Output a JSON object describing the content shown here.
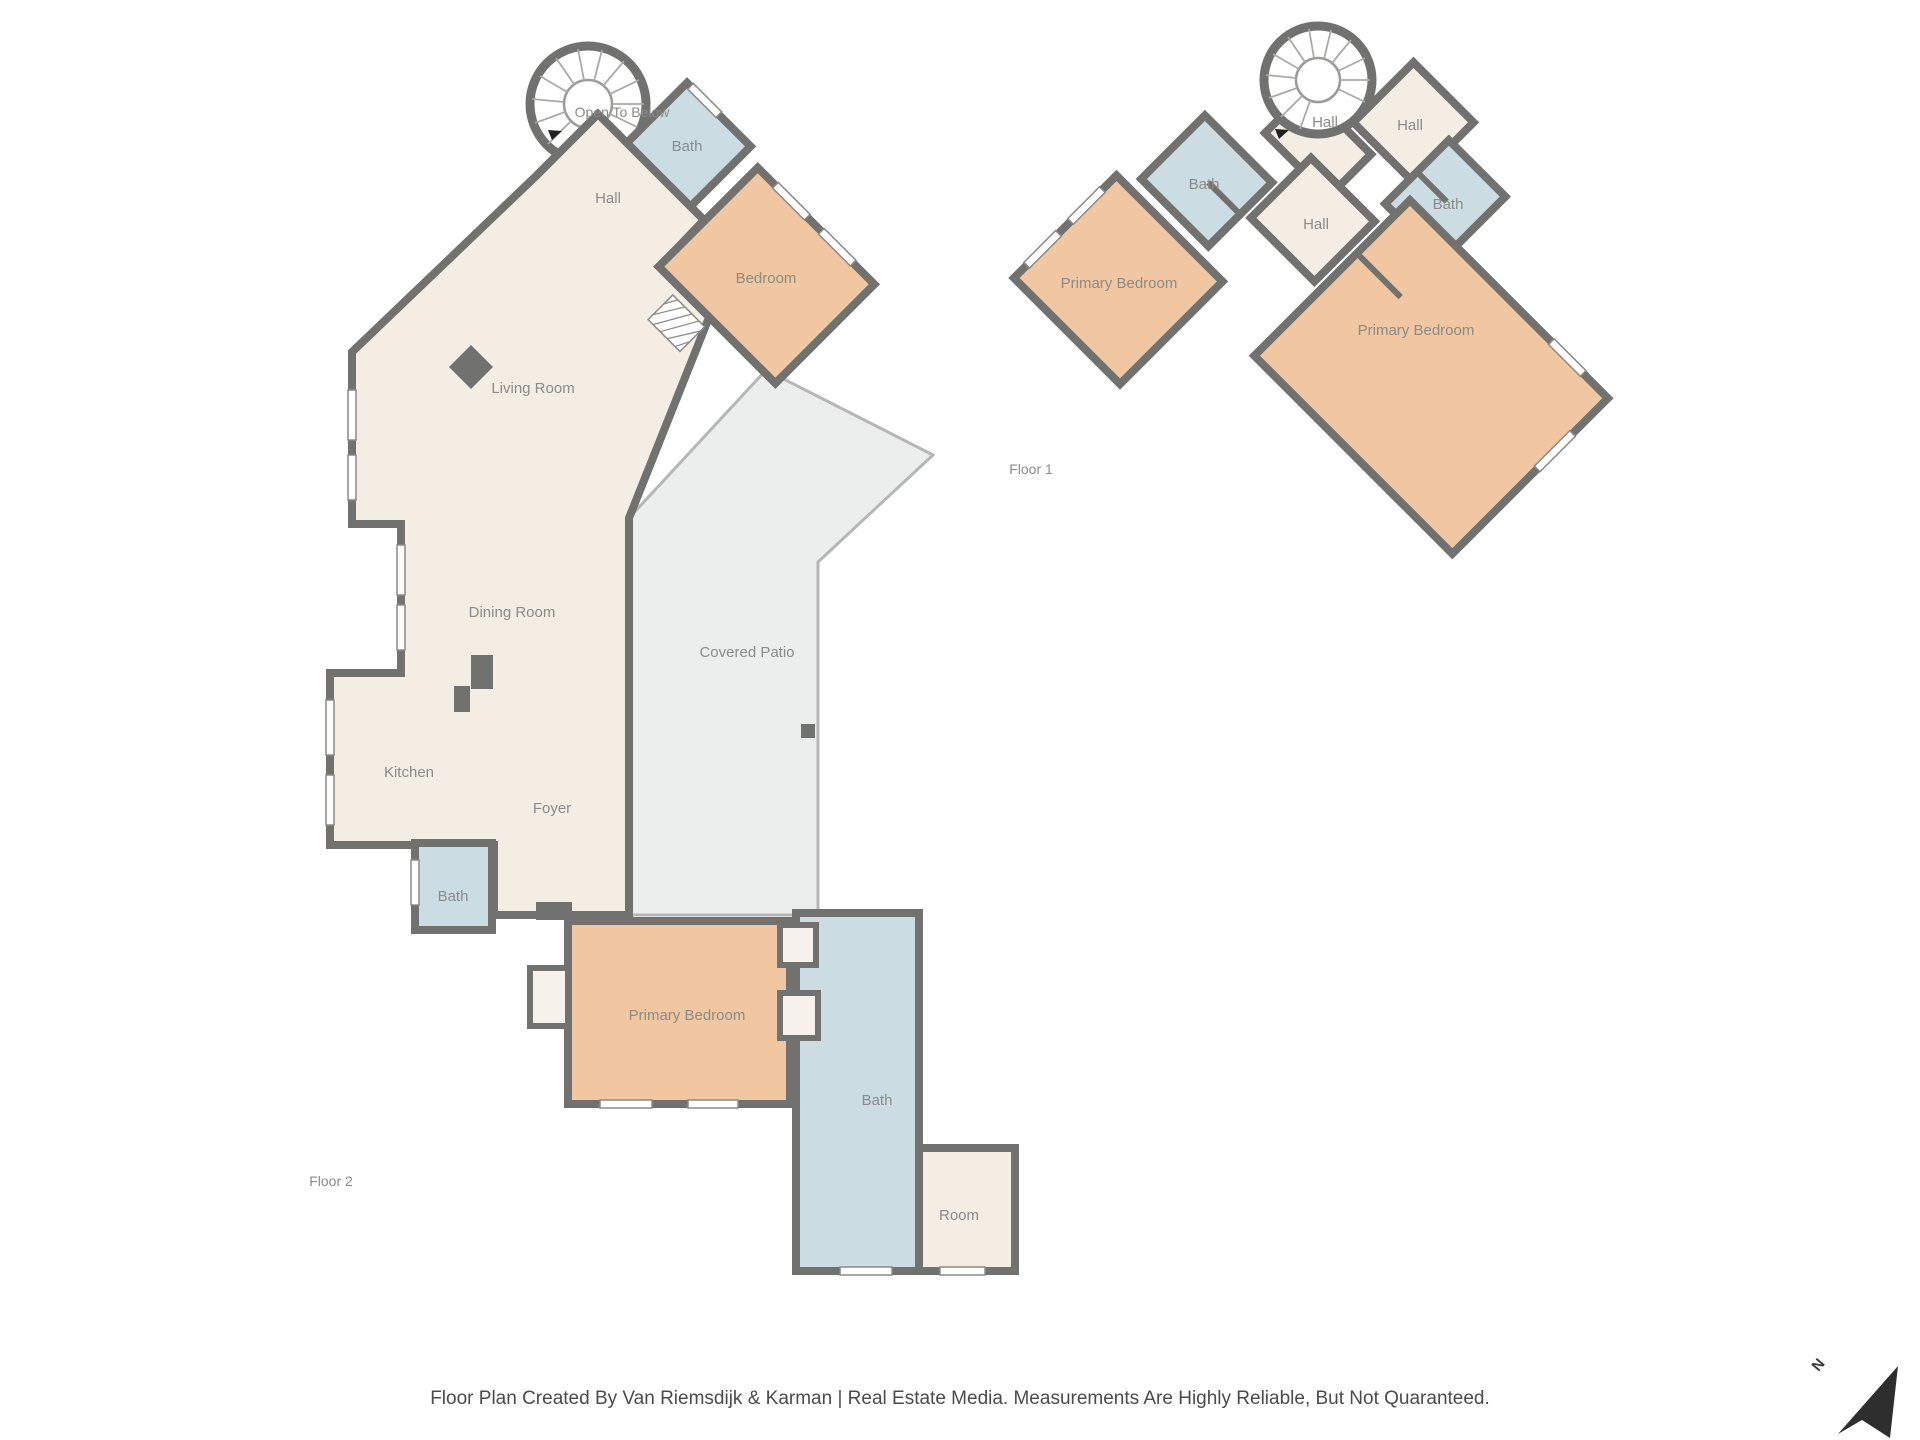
{
  "page": {
    "background": "#ffffff"
  },
  "colors": {
    "wall": "#717170",
    "floor_beige": "#f3ede4",
    "room_orange": "#f0c7a0",
    "room_blue": "#cbdde2",
    "patio_gray": "#eceeee",
    "label_text": "#8b8b89",
    "footer_text": "#4b4b4b",
    "north_arrow": "#2e2e2e"
  },
  "floor2": {
    "name_label": "Floor 2",
    "rooms": {
      "open_to_below": "Open To Below",
      "hall": "Hall",
      "bath_top": "Bath",
      "bedroom": "Bedroom",
      "living_room": "Living Room",
      "dining_room": "Dining Room",
      "kitchen": "Kitchen",
      "foyer": "Foyer",
      "bath_mid": "Bath",
      "covered_patio": "Covered Patio",
      "primary_bedroom": "Primary Bedroom",
      "bath_lower": "Bath",
      "room": "Room"
    }
  },
  "floor1": {
    "name_label": "Floor 1",
    "rooms": {
      "hall_upper_left": "Hall",
      "hall_upper_right": "Hall",
      "bath_left": "Bath",
      "hall_center": "Hall",
      "bath_right": "Bath",
      "primary_bedroom_left": "Primary Bedroom",
      "primary_bedroom_right": "Primary Bedroom"
    }
  },
  "footer": {
    "credit": "Floor Plan Created By Van Riemsdijk & Karman | Real Estate Media. Measurements Are Highly Reliable, But Not Quaranteed."
  },
  "compass": {
    "north_label": "N"
  }
}
